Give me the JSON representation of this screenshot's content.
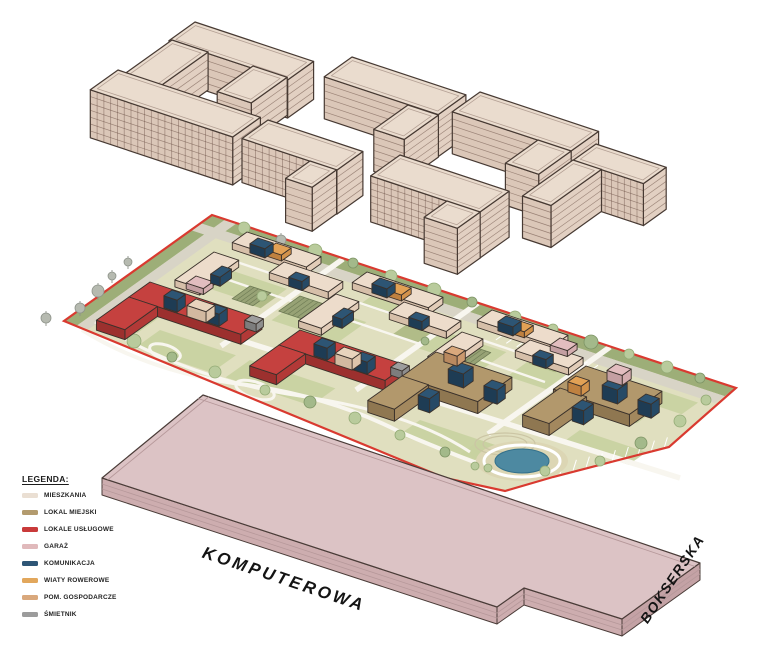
{
  "legend": {
    "title": "LEGENDA:",
    "items": [
      {
        "name": "mieszkania",
        "label": "MIESZKANIA",
        "color": "#eadfd3"
      },
      {
        "name": "lokal-miejski",
        "label": "LOKAL MIEJSKI",
        "color": "#b39b6e"
      },
      {
        "name": "lokale-uslugowe",
        "label": "LOKALE USŁUGOWE",
        "color": "#c93a3a"
      },
      {
        "name": "garaz",
        "label": "GARAŻ",
        "color": "#e0b9bb"
      },
      {
        "name": "komunikacja",
        "label": "KOMUNIKACJA",
        "color": "#2e5676"
      },
      {
        "name": "wiaty-rowerowe",
        "label": "WIATY ROWEROWE",
        "color": "#e2a75c"
      },
      {
        "name": "pom-gospodarcze",
        "label": "POM. GOSPODARCZE",
        "color": "#d9a87c"
      },
      {
        "name": "smietnik",
        "label": "ŚMIETNIK",
        "color": "#9c9c9c"
      }
    ]
  },
  "streets": {
    "komputerowa": "KOMPUTEROWA",
    "bokserska": "BOKSERSKA"
  },
  "palette": {
    "site_boundary": "#d93a30",
    "water": "#4d89a1",
    "ground": "#e0dfbf",
    "greenery_band": "#9dae78",
    "road": "#d8d4c6",
    "path": "#f8f6ef",
    "building_beige_top": "#eadcce",
    "garage_slab_top": "#dcc3c5"
  }
}
